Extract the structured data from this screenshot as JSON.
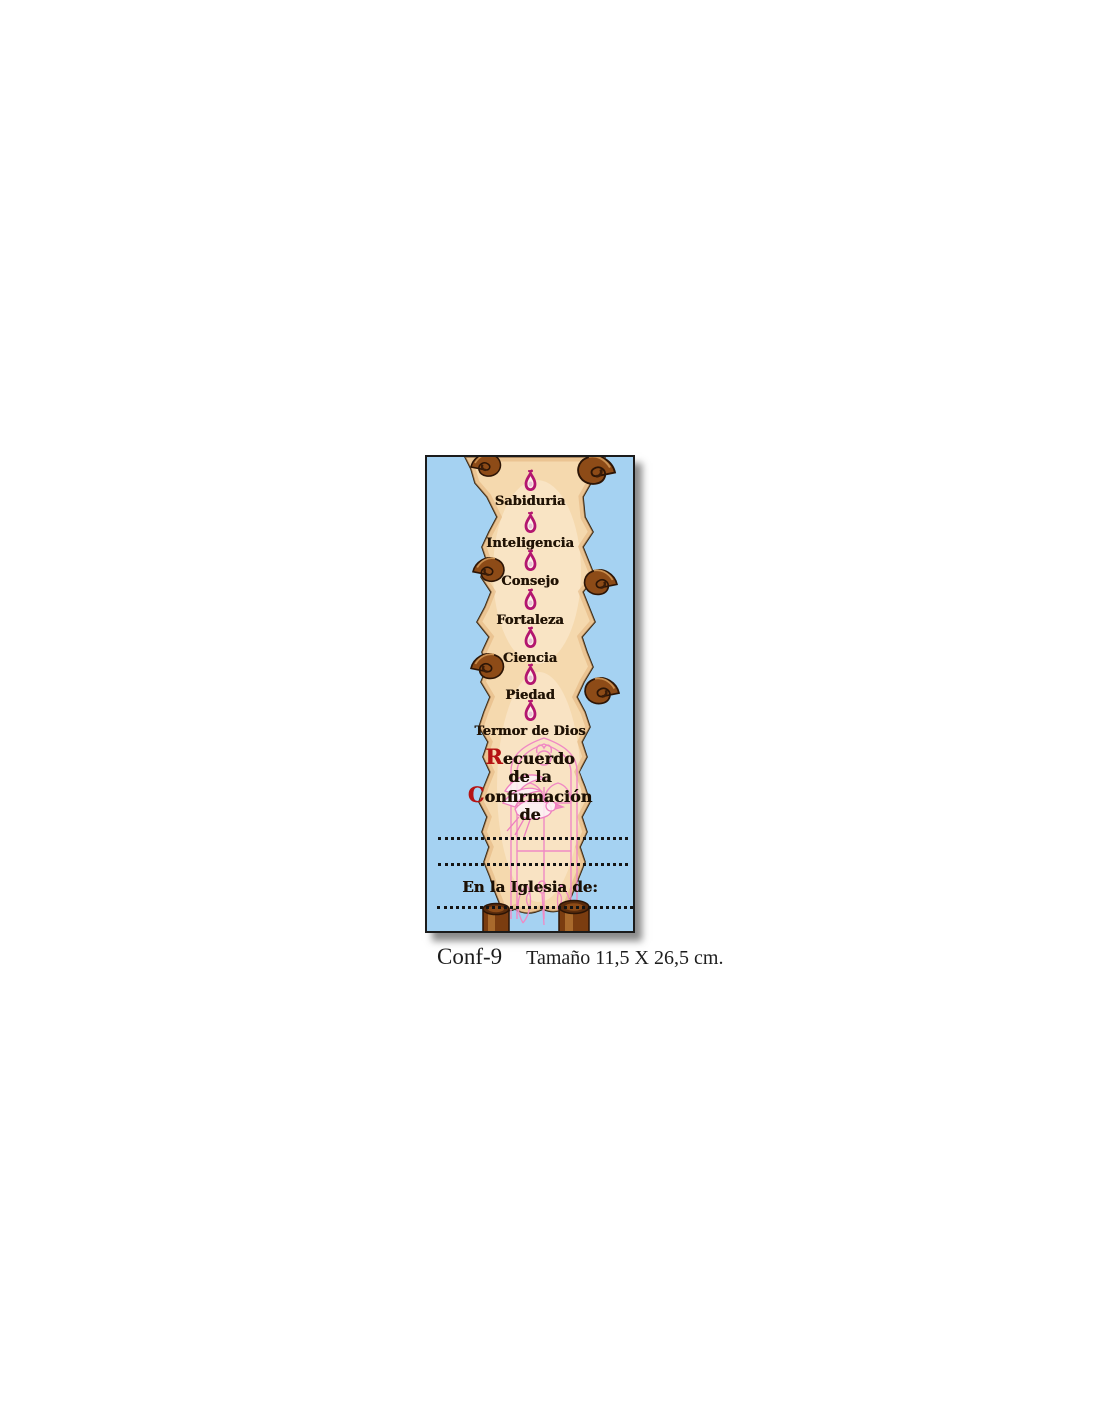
{
  "card": {
    "gifts": [
      {
        "label": "Sabiduria"
      },
      {
        "label": "Inteligencia"
      },
      {
        "label": "Consejo"
      },
      {
        "label": "Fortaleza"
      },
      {
        "label": "Ciencia"
      },
      {
        "label": "Piedad"
      },
      {
        "label": "Termor de Dios"
      }
    ],
    "memorial": {
      "line1_initial": "R",
      "line1_rest": "ecuerdo",
      "line2": "de la",
      "line3_initial": "C",
      "line3_rest": "onfirmación",
      "line4": "de"
    },
    "church_label": "En la Iglesia de:",
    "icons": {
      "flame": "holy-spirit-flame-drop",
      "dove": "holy-spirit-dove",
      "window": "gothic-church-window",
      "scroll": "parchment-scroll"
    },
    "colors": {
      "card_background": "#a5d2f2",
      "parchment": "#f5d9ae",
      "parchment_highlight": "#fbead0",
      "scroll_curl_brown": "#8d4b17",
      "flame_magenta": "#b3166f",
      "blackletter_text": "#1c1004",
      "drop_cap_red": "#b51313",
      "line_art_pink": "#f089c4",
      "border": "#1b1b1b"
    }
  },
  "caption": {
    "code": "Conf-9",
    "size_text": "Tamaño 11,5 X 26,5 cm."
  }
}
